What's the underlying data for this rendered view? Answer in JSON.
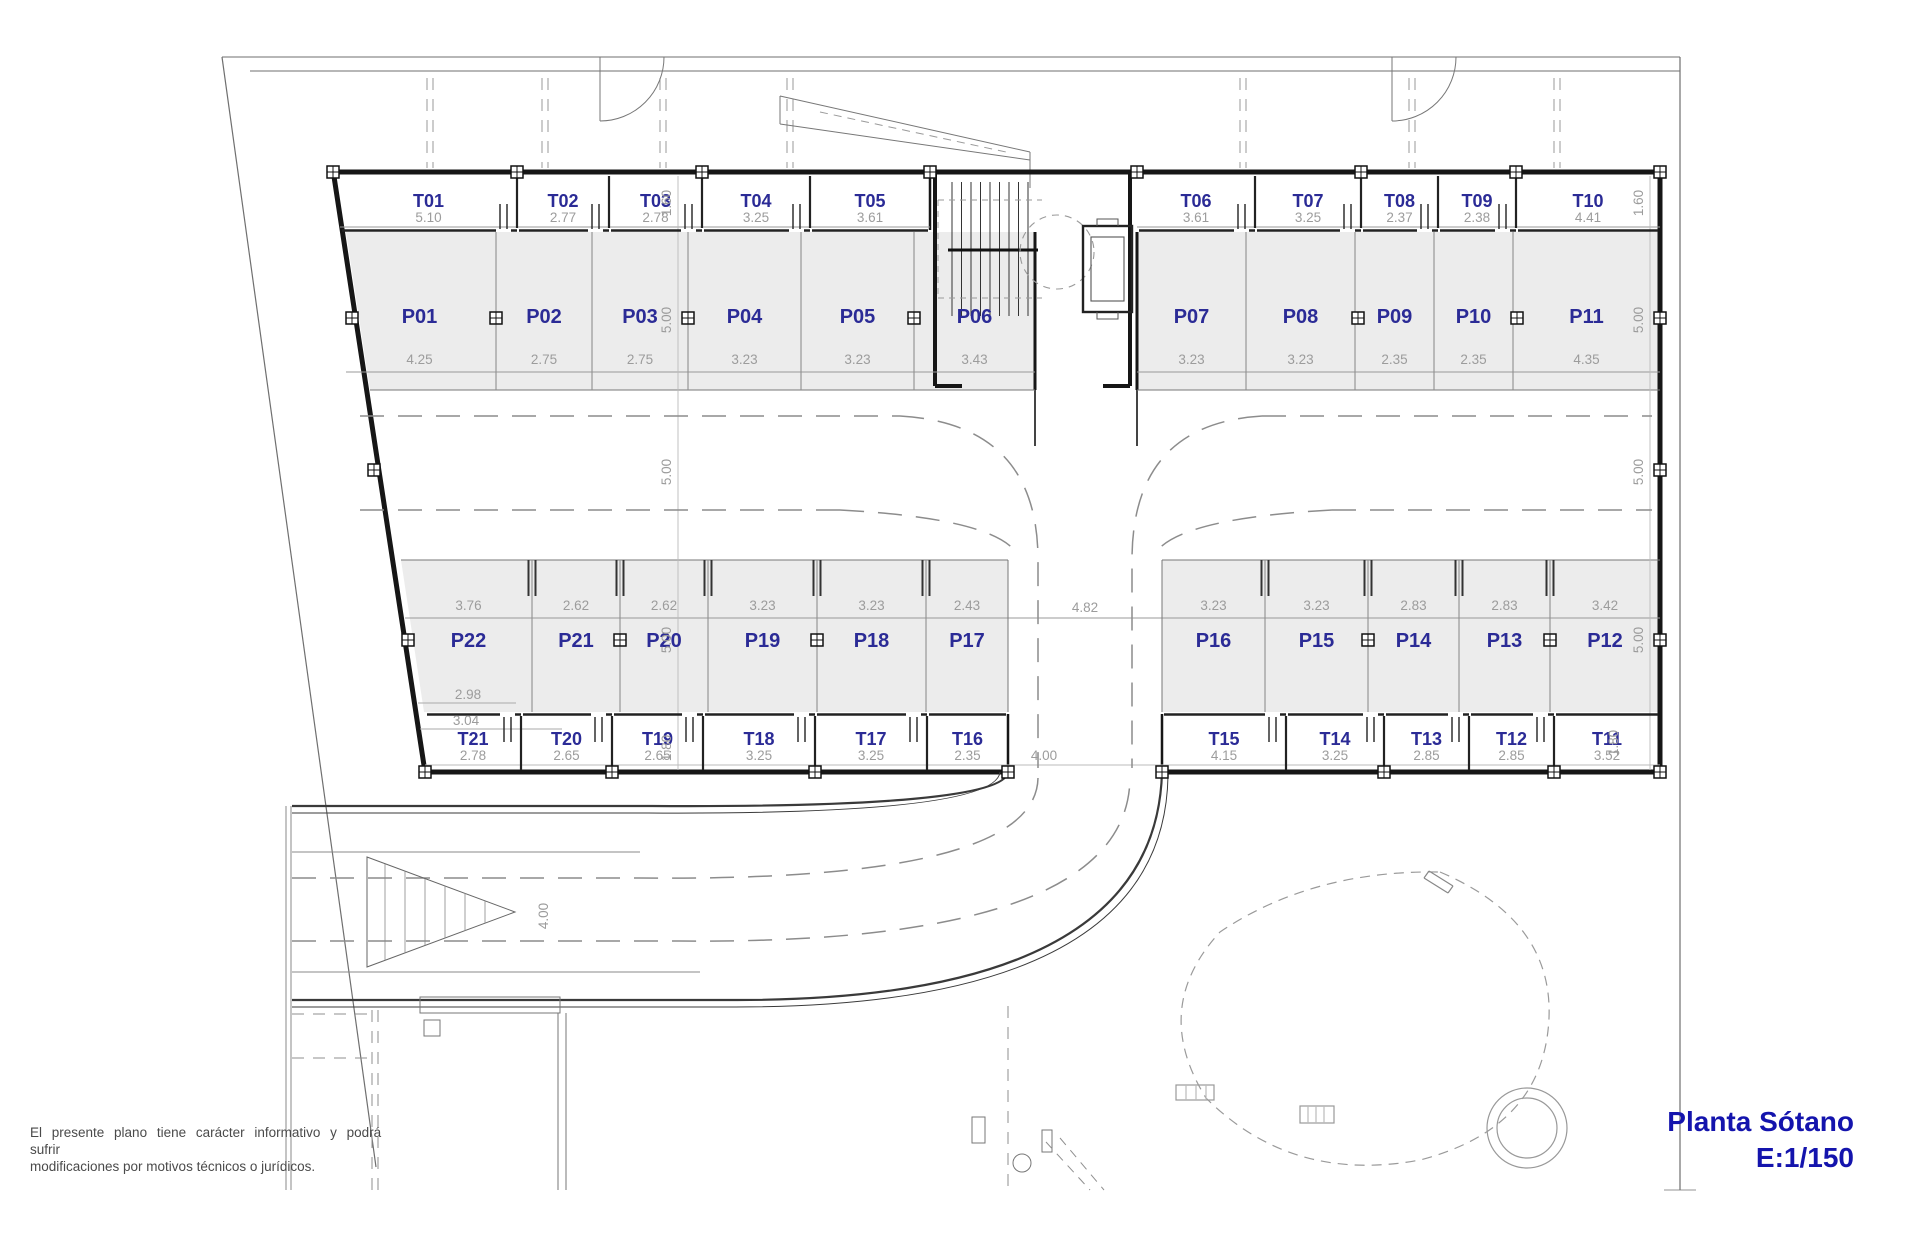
{
  "title": {
    "name": "Planta Sótano",
    "scale": "E:1/150"
  },
  "disclaimer": {
    "line1": "El presente plano tiene carácter informativo y podrá sufrir",
    "line2": "modificaciones por motivos técnicos o jurídicos."
  },
  "colors": {
    "label_blue": "#2b2b96",
    "title_blue": "#1414ad",
    "dim_gray": "#9c9c9c",
    "stall_fill": "#ececec",
    "wall_black": "#161616"
  },
  "plan": {
    "storage_top_left": [
      {
        "id": "T01",
        "width": "5.10"
      },
      {
        "id": "T02",
        "width": "2.77"
      },
      {
        "id": "T03",
        "width": "2.78"
      },
      {
        "id": "T04",
        "width": "3.25"
      },
      {
        "id": "T05",
        "width": "3.61"
      }
    ],
    "storage_top_right": [
      {
        "id": "T06",
        "width": "3.61"
      },
      {
        "id": "T07",
        "width": "3.25"
      },
      {
        "id": "T08",
        "width": "2.37"
      },
      {
        "id": "T09",
        "width": "2.38"
      },
      {
        "id": "T10",
        "width": "4.41"
      }
    ],
    "parking_top_left": [
      {
        "id": "P01",
        "width": "4.25"
      },
      {
        "id": "P02",
        "width": "2.75"
      },
      {
        "id": "P03",
        "width": "2.75"
      },
      {
        "id": "P04",
        "width": "3.23"
      },
      {
        "id": "P05",
        "width": "3.23"
      },
      {
        "id": "P06",
        "width": "3.43"
      }
    ],
    "parking_top_right": [
      {
        "id": "P07",
        "width": "3.23"
      },
      {
        "id": "P08",
        "width": "3.23"
      },
      {
        "id": "P09",
        "width": "2.35"
      },
      {
        "id": "P10",
        "width": "2.35"
      },
      {
        "id": "P11",
        "width": "4.35"
      }
    ],
    "parking_mid_left": [
      {
        "id": "P22",
        "width": "3.76"
      },
      {
        "id": "P21",
        "width": "2.62"
      },
      {
        "id": "P20",
        "width": "2.62"
      },
      {
        "id": "P19",
        "width": "3.23"
      },
      {
        "id": "P18",
        "width": "3.23"
      },
      {
        "id": "P17",
        "width": "2.43"
      }
    ],
    "parking_mid_right": [
      {
        "id": "P16",
        "width": "3.23"
      },
      {
        "id": "P15",
        "width": "3.23"
      },
      {
        "id": "P14",
        "width": "2.83"
      },
      {
        "id": "P13",
        "width": "2.83"
      },
      {
        "id": "P12",
        "width": "3.42"
      }
    ],
    "storage_bottom_left": [
      {
        "id": "T21",
        "width": "2.78"
      },
      {
        "id": "T20",
        "width": "2.65"
      },
      {
        "id": "T19",
        "width": "2.65"
      },
      {
        "id": "T18",
        "width": "3.25"
      },
      {
        "id": "T17",
        "width": "3.25"
      },
      {
        "id": "T16",
        "width": "2.35"
      }
    ],
    "storage_bottom_right": [
      {
        "id": "T15",
        "width": "4.15"
      },
      {
        "id": "T14",
        "width": "3.25"
      },
      {
        "id": "T13",
        "width": "2.85"
      },
      {
        "id": "T12",
        "width": "2.85"
      },
      {
        "id": "T11",
        "width": "3.52"
      }
    ],
    "depth_dims": {
      "storage_top": "1.60",
      "parking_top": "5.00",
      "aisle": "5.00",
      "parking_mid": "5.00",
      "storage_bottom": "1.80"
    },
    "extra_dims": {
      "driveway_width": "4.82",
      "south_driveway": "4.00",
      "ramp_width": "4.00",
      "p22_front": "2.98",
      "t21_back": "3.04"
    }
  }
}
